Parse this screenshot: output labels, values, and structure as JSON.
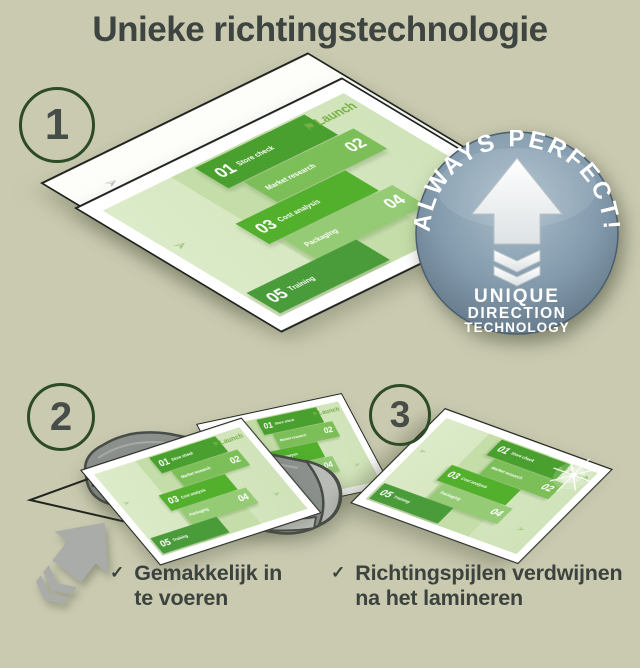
{
  "title": "Unieke richtingstechnologie",
  "step_markers": [
    "1",
    "2",
    "3"
  ],
  "infographic": {
    "launch_label": "Launch",
    "items": [
      {
        "num": "01",
        "label": "Store check"
      },
      {
        "num": "02",
        "label": "Market research"
      },
      {
        "num": "03",
        "label": "Cost analysis"
      },
      {
        "num": "04",
        "label": "Packaging"
      },
      {
        "num": "05",
        "label": "Training"
      }
    ]
  },
  "badge": {
    "arc_text": "ALWAYS PERFECT!",
    "line1": "UNIQUE",
    "line2": "DIRECTION",
    "line3": "TECHNOLOGY"
  },
  "bullets": [
    {
      "mark": "✓",
      "text": "Gemakkelijk in te voeren"
    },
    {
      "mark": "✓",
      "text": "Richtingspijlen verdwijnen na het lamineren"
    }
  ],
  "colors": {
    "background": "#c9cab0",
    "title_text": "#3e4541",
    "brand_green": "#52b02c",
    "light_green_page": "#d4e6be",
    "badge_steel": "#829aac",
    "machine_gray": "#8b908c",
    "arrow_gray": "#a9aca8",
    "text_dark": "#3c433f"
  }
}
